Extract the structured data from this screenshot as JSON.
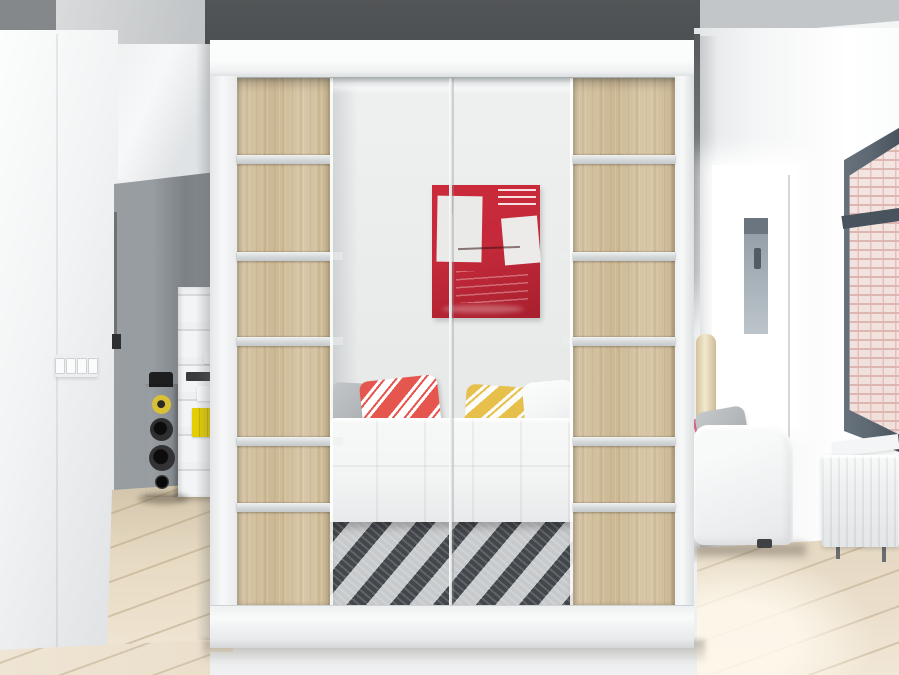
{
  "meta": {
    "type": "photograph",
    "subject": "White sliding-door wardrobe with sonoma oak panels and central mirror standing in a bright modern interior",
    "width_px": 899,
    "height_px": 675
  },
  "palette": {
    "wall_white": "#f3f4f5",
    "wall_shadow": "#e0e3e4",
    "ceiling_light": "#d6d8d9",
    "ceiling_mid": "#c3c6c8",
    "corner_gray": "#85888b",
    "accent_dark": "#4d5052",
    "hall_gray": "#8e9397",
    "hall_gray_dark": "#7b8186",
    "frame_white": "#f4f5f6",
    "frame_shade": "#e2e4e5",
    "wood_light": "#d8c7a8",
    "wood_base": "#ccb893",
    "aluminum_hi": "#f0f2f2",
    "aluminum_lo": "#c5c9cb",
    "mirror_top": "#eff1f1",
    "mirror_bot": "#e2e4e4",
    "art_red": "#c52a3a",
    "art_red_dark": "#a81f2e",
    "art_white": "#eaeae8",
    "pillow_red": "#e5564e",
    "pillow_yellow": "#e6c04a",
    "pillow_gray": "#b4b7ba",
    "pillow_white": "#f4f5f5",
    "sofa_white": "#f3f4f4",
    "rug_dark": "#43474b",
    "rug_light": "#c7cacc",
    "floor_base": "#ebdfcc",
    "floor_line": "#c8b694",
    "window_frame": "#5d6873",
    "window_frame_dark": "#49535d",
    "brick_bg": "#f0dfdb",
    "brick_line": "#ddb6b1",
    "radiator_white": "#eff1f2",
    "lamp_light": "#f2e8cf",
    "lamp_dark": "#d5c29c",
    "speaker_wood": "#c49a5f",
    "speaker_wood_hi": "#d6ad72",
    "driver_yellow": "#d9c135",
    "shelf_white": "#eef0f1",
    "book_yellow": "#e5ce00"
  },
  "scene": {
    "wardrobe": {
      "label": "two-door sliding wardrobe",
      "finish": "white frame, sonoma oak side panels, central mirror doors",
      "aluminum_strips_per_panel": 5
    },
    "mirror_reflection": {
      "artwork": "red abstract painting with white blocks and scribbles",
      "sofa": "white tufted leather sofa",
      "pillows": [
        "grey",
        "red-white diagonal striped",
        "yellow-white diagonal striped",
        "white"
      ],
      "rug": "black and silver striped rug"
    },
    "left_room": {
      "items": [
        "four-gang light switch",
        "hallway opening with grey wall",
        "wooden hi-fi tower speaker",
        "white shelving unit",
        "yellow books"
      ]
    },
    "right_room": {
      "items": [
        "beige floor lamp",
        "white sofa with grey pillow",
        "white panel radiator",
        "tall dark-framed window with brick view",
        "light wood plank floor"
      ]
    }
  }
}
